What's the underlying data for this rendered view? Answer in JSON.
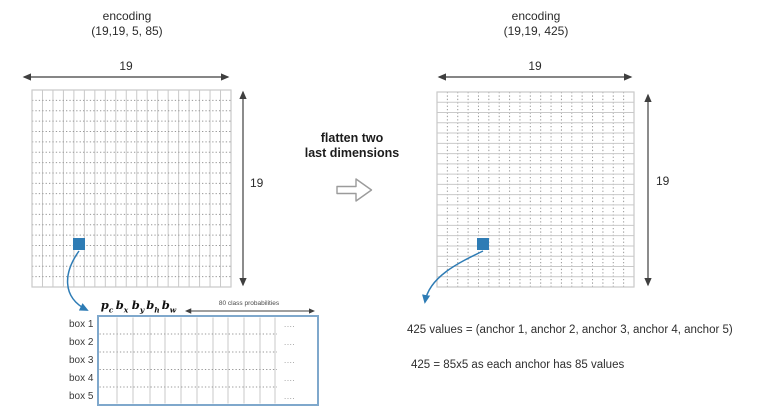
{
  "left": {
    "title_line1": "encoding",
    "title_line2": "(19,19, 5, 85)",
    "dim_top": "19",
    "dim_side": "19",
    "grid": {
      "rows": 19,
      "cols": 19
    }
  },
  "middle": {
    "label_line1": "flatten two",
    "label_line2": "last dimensions"
  },
  "right": {
    "title_line1": "encoding",
    "title_line2": "(19,19, 425)",
    "dim_top": "19",
    "dim_side": "19",
    "grid": {
      "rows": 19,
      "cols": 19
    },
    "note1": "425 values = (anchor 1, anchor 2, anchor 3, anchor 4, anchor 5)",
    "note2": "425 = 85x5 as each anchor has 85 values"
  },
  "table": {
    "headers": [
      {
        "base": "p",
        "sub": "c"
      },
      {
        "base": "b",
        "sub": "x"
      },
      {
        "base": "b",
        "sub": "y"
      },
      {
        "base": "b",
        "sub": "h"
      },
      {
        "base": "b",
        "sub": "w"
      }
    ],
    "class_prob_label": "80 class probabilities",
    "rows": [
      "box 1",
      "box 2",
      "box 3",
      "box 4",
      "box 5"
    ],
    "ellipsis": "...."
  },
  "colors": {
    "accent_blue": "#2e7cb5",
    "table_border_blue": "#7fa8cc",
    "grid_line": "#c9c9c9",
    "grid_dotted": "#989898",
    "dim_line": "#3f3f3f",
    "text": "#2b2b2b"
  }
}
